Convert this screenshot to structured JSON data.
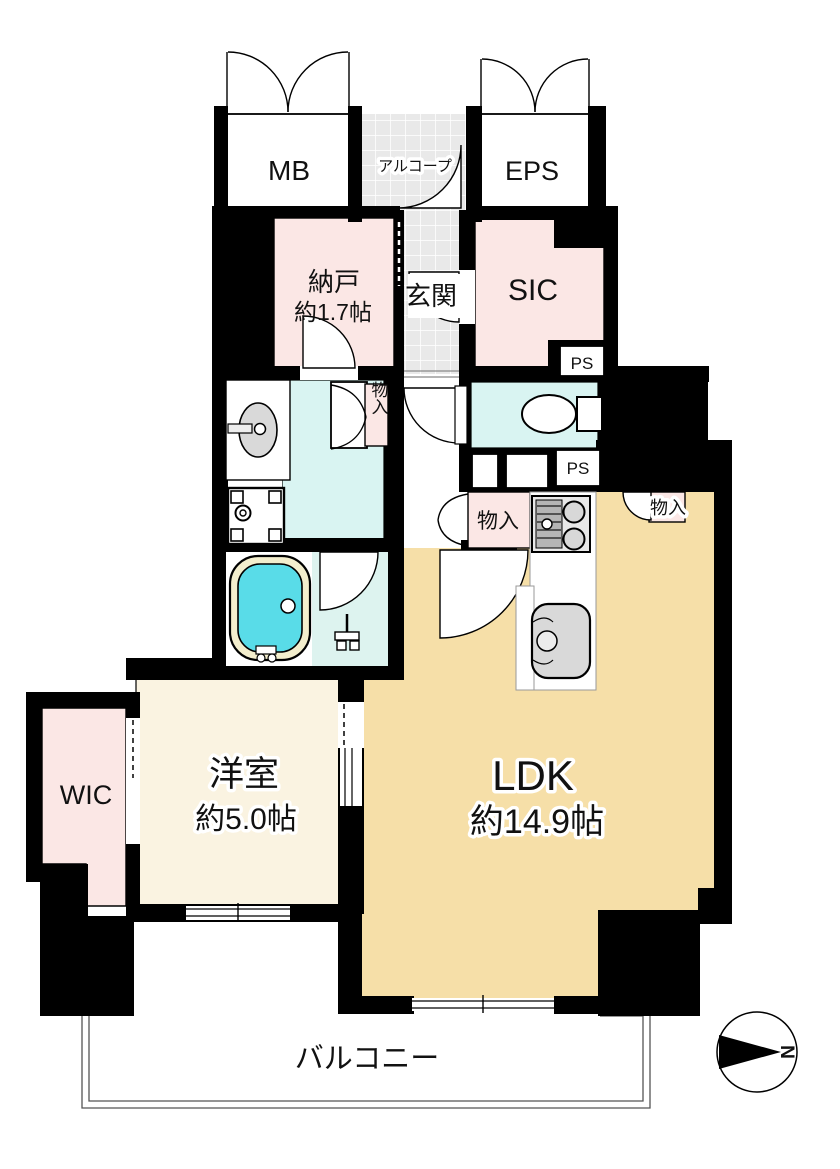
{
  "floorplan": {
    "title": "apartment-floor-plan",
    "rooms": {
      "mb": "MB",
      "alcove": "アルコープ",
      "eps": "EPS",
      "nando": "納戸",
      "nando_size": "約1.7帖",
      "genkan": "玄関",
      "sic": "SIC",
      "ps": "PS",
      "closet": "物入",
      "ldk": "LDK",
      "ldk_size": "約14.9帖",
      "western": "洋室",
      "western_size": "約5.0帖",
      "wic": "WIC",
      "balcony": "バルコニー"
    },
    "compass": {
      "north": "N"
    },
    "colors": {
      "wall": "#000000",
      "pink": "#fbe7e5",
      "cyan": "#d9f4f2",
      "tan": "#f6dfa8",
      "cream": "#faf3e1",
      "tub_water": "#59dce8",
      "tub_rim": "#f3eecd",
      "tile": "#e9e9e9",
      "fixture_gray": "#d9d9d9"
    }
  }
}
